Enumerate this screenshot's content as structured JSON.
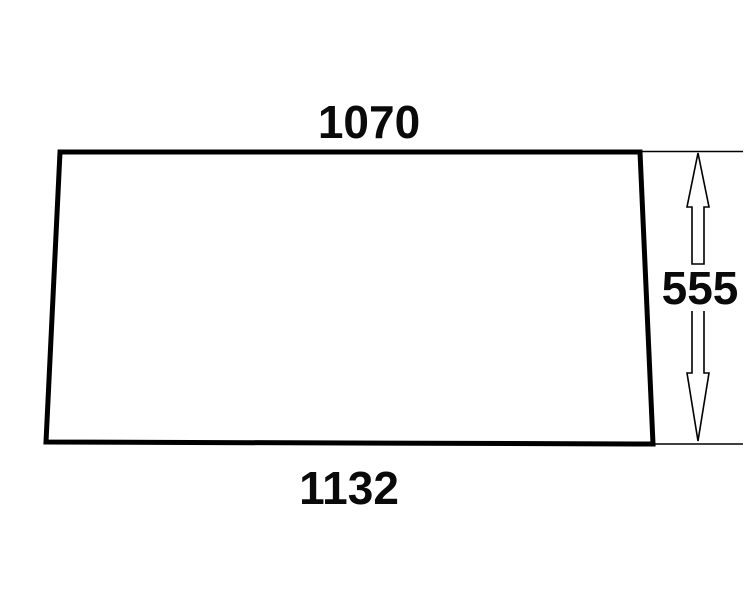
{
  "drawing": {
    "shape": "trapezoid-panel-outline",
    "background_color": "#ffffff",
    "line_color": "#000000",
    "dimension_labels": {
      "top_width": "1070",
      "bottom_width": "1132",
      "right_height": "555"
    },
    "icons": {
      "dimension_arrow": "double-headed-vertical-outline-arrow"
    }
  }
}
